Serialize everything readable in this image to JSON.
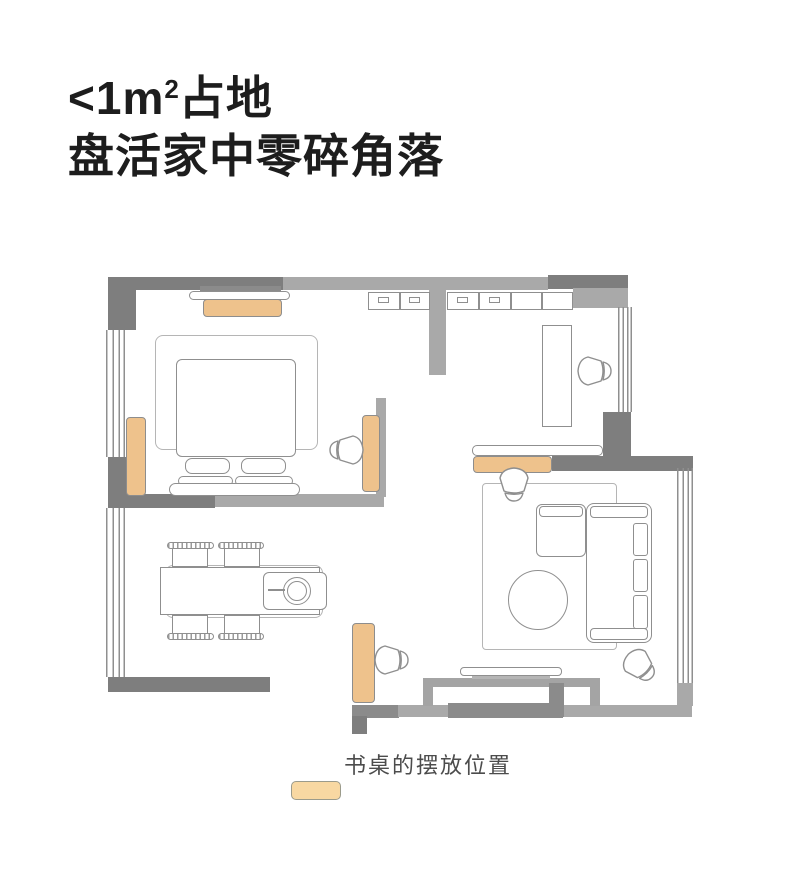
{
  "title": {
    "line1_prefix": "<1m",
    "line1_sup": "2",
    "line1_suffix": "占地",
    "line2": "盘活家中零碎角落"
  },
  "legend": {
    "label": "书桌的摆放位置"
  },
  "floorplan": {
    "desk_position_highlights": [
      "bedroom-top-wall",
      "bedroom-left-window-wall",
      "bedroom-right-wall",
      "living-room-top-wall",
      "hallway-bottom-wall"
    ],
    "rooms": [
      "bedroom",
      "dining-area",
      "study-nook",
      "living-room"
    ]
  },
  "colors": {
    "wall_dark": "#7e7e7e",
    "wall_mid": "#8b8b8b",
    "wall_light": "#a9a9a9",
    "niche": "#a4a4a4",
    "line": "#8f8f8f",
    "line_soft": "#b5b5b5",
    "desk_fill": "#eec28c",
    "desk_border": "#8d8d8d",
    "legend_fill": "#f8d8a2",
    "title_color": "#1d1d1d",
    "legend_text": "#4c4c4c"
  }
}
